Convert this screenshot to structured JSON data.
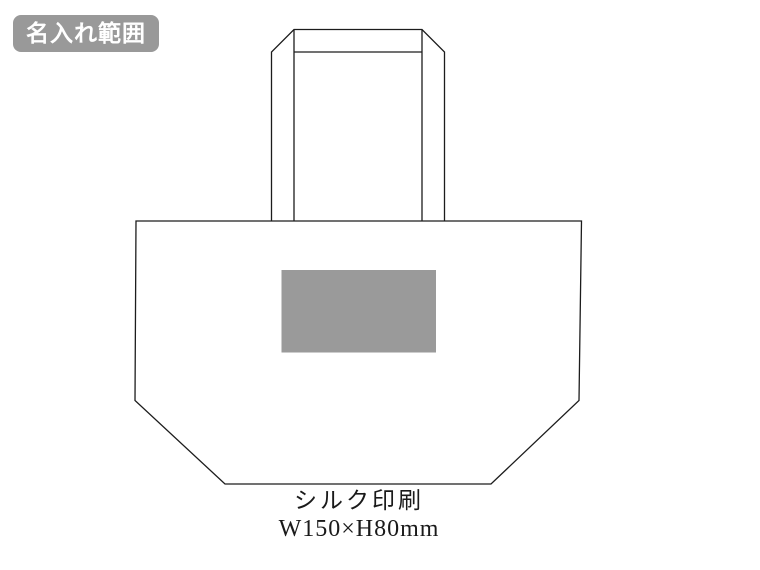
{
  "badge": {
    "label": "名入れ範囲"
  },
  "diagram": {
    "subject": "tote-bag-front-outline",
    "line_color": "#1c1c1c",
    "background_color": "#ffffff",
    "print_area": {
      "fill_color": "#9A9A9A"
    }
  },
  "caption": {
    "method": "シルク印刷",
    "size": "W150×H80mm",
    "width_mm": 150,
    "height_mm": 80
  }
}
